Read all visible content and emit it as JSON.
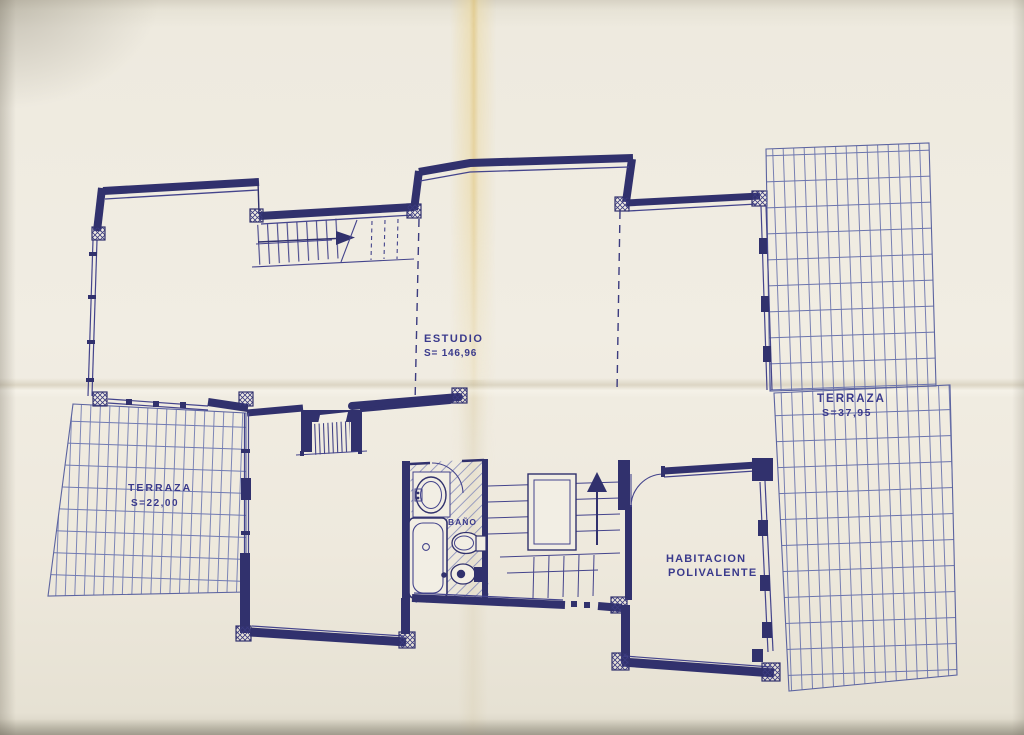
{
  "plan": {
    "rooms": {
      "estudio": {
        "label": "ESTUDIO",
        "area": "S= 146,96"
      },
      "terraza_left": {
        "label": "TERRAZA",
        "area": "S=22,00"
      },
      "terraza_right": {
        "label": "TERRAZA",
        "area": "S=37,95"
      },
      "bano": {
        "label": "BAÑO"
      },
      "habitacion": {
        "label_line1": "HABITACION",
        "label_line2": "POLIVALENTE"
      }
    },
    "colors": {
      "ink": "#31316d",
      "thin_line": "#44448c",
      "grid_line": "#6b74ad",
      "paper": "#f0ece2",
      "crease": "#e0c478"
    }
  }
}
